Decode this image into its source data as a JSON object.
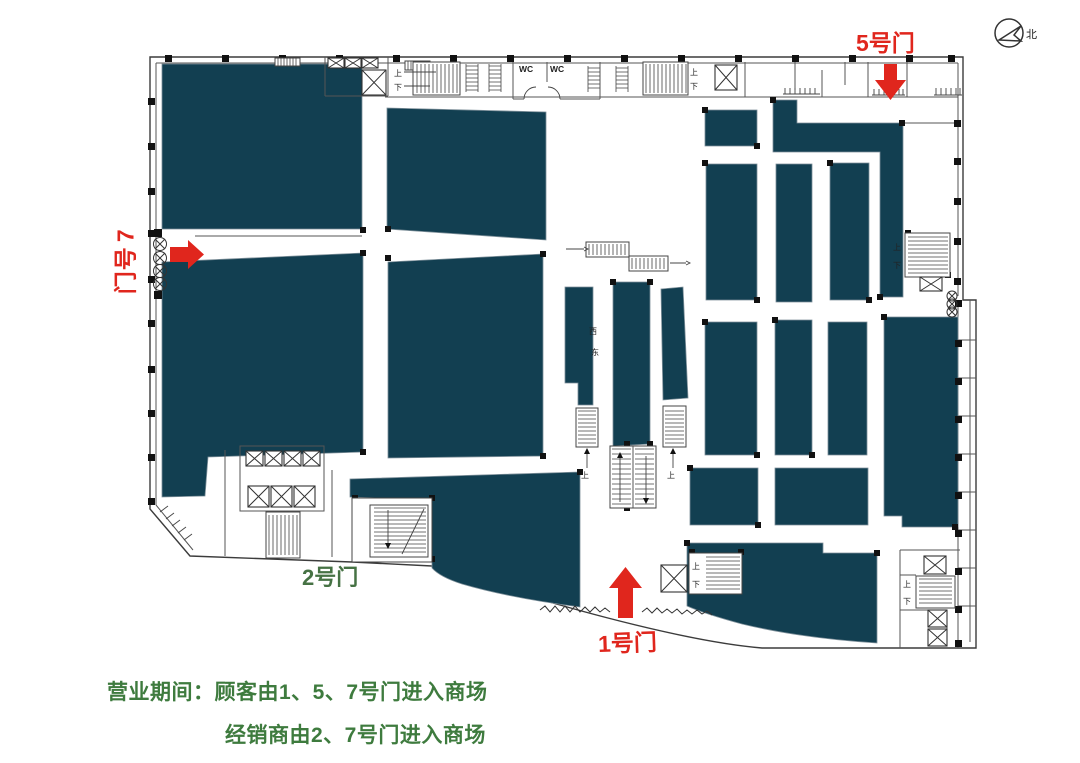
{
  "compass": {
    "north_label": "北"
  },
  "doors": {
    "door1": {
      "label": "1号门"
    },
    "door2": {
      "label": "2号门"
    },
    "door5": {
      "label": "5号门"
    },
    "door7": {
      "label": "7号门"
    }
  },
  "plan_labels": {
    "wc": "WC",
    "west": "西",
    "east": "东",
    "up": "上",
    "down": "下"
  },
  "legend": {
    "line1": "营业期间：顾客由1、5、7号门进入商场",
    "line2": "经销商由2、7号门进入商场"
  },
  "colors": {
    "store_block": "#123f51",
    "door_arrow_red": "#e0261d",
    "legend_green": "#3e7b3e",
    "door2_green": "#467244",
    "wall_gray": "#3c3c3c"
  }
}
